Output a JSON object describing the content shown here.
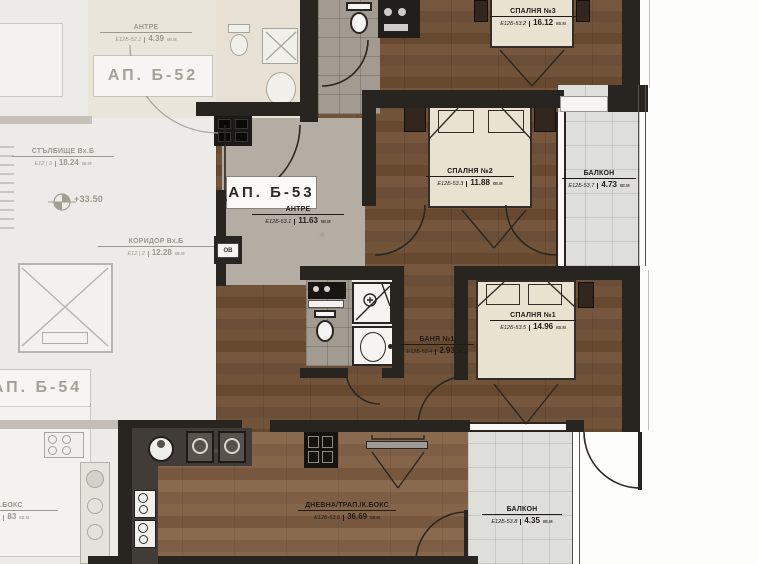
{
  "plan_title": "Residential floor plan — apartment АП. Б-53 highlighted",
  "apartments": {
    "b52": "АП. Б-52",
    "b53": "АП. Б-53",
    "b54": "АП. Б-54"
  },
  "rooms": {
    "antre52": {
      "name": "АНТРЕ",
      "code": "Е12Б-52.1",
      "area": "4.39",
      "unit": "кв.м"
    },
    "stairs": {
      "name": "СТЪЛБИЩЕ Вх.Б",
      "code": "Е12 | 3",
      "area": "18.24",
      "unit": "кв.м"
    },
    "corridor": {
      "name": "КОРИДОР Вх.Б",
      "code": "Е12 | 2",
      "area": "12.28",
      "unit": "кв.м"
    },
    "antre53": {
      "name": "АНТРЕ",
      "code": "Е12Б-53.1",
      "area": "11.63",
      "unit": "кв.м"
    },
    "bedroom3": {
      "name": "СПАЛНЯ №3",
      "code": "Е12Б-53.2",
      "area": "16.12",
      "unit": "кв.м"
    },
    "bedroom2": {
      "name": "СПАЛНЯ №2",
      "code": "Е12Б-53.3",
      "area": "11.88",
      "unit": "кв.м"
    },
    "bath1": {
      "name": "БАНЯ №1",
      "code": "Е12Б-53.4",
      "area": "2.93",
      "unit": "кв.м"
    },
    "bedroom1": {
      "name": "СПАЛНЯ №1",
      "code": "Е12Б-53.5",
      "area": "14.96",
      "unit": "кв.м"
    },
    "living": {
      "name": "ДНЕВНА/ТРАП./К.БОКС",
      "code": "Е12Б-53.6",
      "area": "36.69",
      "unit": "кв.м"
    },
    "balcony_right": {
      "name": "БАЛКОН",
      "code": "Е12Б-53.7",
      "area": "4.73",
      "unit": "кв.м"
    },
    "balcony_bottom": {
      "name": "БАЛКОН",
      "code": "Е12Б-53.8",
      "area": "4.35",
      "unit": "кв.м"
    },
    "living54": {
      "name": "/К.БОКС",
      "code": "Е12Б",
      "area": "83",
      "unit": "кв.м"
    }
  },
  "annotations": {
    "elevation": "+33.50",
    "meter_box": "ОВ"
  },
  "icons": [
    "toilet-icon",
    "shower-icon",
    "washbasin-icon",
    "bed-icon",
    "pillow-icon",
    "elevator-cross-icon",
    "stove-icon",
    "sink-icon",
    "cooktop-icon",
    "washing-machine-icon",
    "tv-icon",
    "door-arc",
    "dimension-v-mark",
    "elevation-marker-icon",
    "wardrobe-icon"
  ],
  "colors": {
    "wall": "#282420",
    "wood_floor": "#6e5038",
    "wood_floor_living": "#84644a",
    "entry_floor": "#b4ada4",
    "bath_tile": "#a29b92",
    "bed_linen": "#e9e2d1",
    "balcony_tile": "#dededa",
    "faded_common": "#edebe7",
    "label_ink": "#1f1b16"
  }
}
